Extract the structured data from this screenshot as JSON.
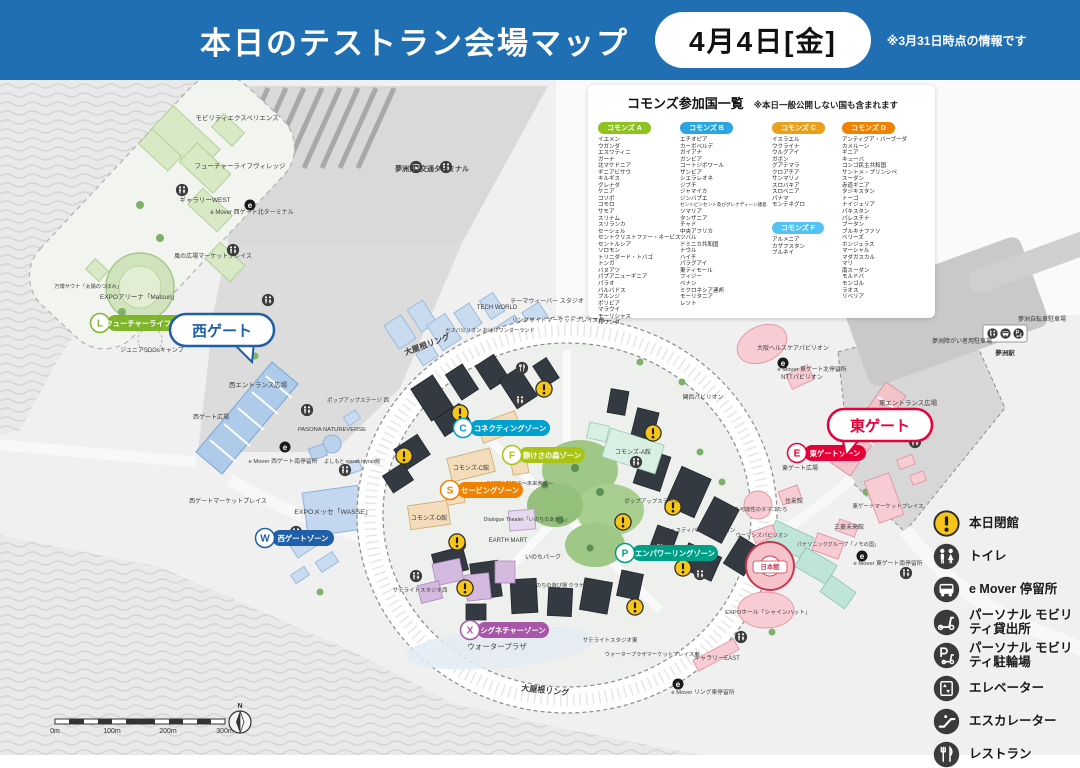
{
  "header": {
    "title": "本日のテストラン会場マップ",
    "date_badge": "4月4日[金]",
    "note": "※3月31日時点の情報です"
  },
  "commons_panel": {
    "title": "コモンズ参加国一覧",
    "note": "※本日一般公開しない国も含まれます",
    "groups": [
      {
        "label": "コモンズ A",
        "color": "#8dc21f",
        "countries": [
          "イエメン",
          "ウガンダ",
          "エスワティニ",
          "ガーナ",
          "北マケドニア",
          "ギニアビサウ",
          "キルギス",
          "グレナダ",
          "ケニア",
          "コソボ",
          "コモロ",
          "サモア",
          "スリナム",
          "スリランカ",
          "セーシェル",
          "セントクリストファー・ネービス",
          "セントルシア",
          "ソロモン",
          "トリニダード・トバゴ",
          "トンガ",
          "バヌアツ",
          "パプアニューギニア",
          "パラオ",
          "バルバドス",
          "ブルンジ",
          "ボリビア",
          "マラウイ",
          "モーリシャス",
          "ルワンダ"
        ]
      },
      {
        "label": "コモンズ B",
        "color": "#2ca6e0",
        "countries": [
          "エチオピア",
          "カーボベルデ",
          "ガイアナ",
          "ガンビア",
          "コートジボワール",
          "ザンビア",
          "シエラレオネ",
          "ジブチ",
          "ジャマイカ",
          "ジンバブエ",
          "セントビンセント及びグレナディーン諸島",
          "ソマリア",
          "タンザニア",
          "チャド",
          "中央アフリカ",
          "ツバル",
          "ドミニカ共和国",
          "ナウル",
          "ハイチ",
          "パラグアイ",
          "東ティモール",
          "フィジー",
          "ベナン",
          "ミクロネシア連邦",
          "モーリタニア",
          "レソト"
        ]
      },
      {
        "label": "コモンズ C",
        "color": "#e8a11c",
        "countries": [
          "イスラエル",
          "ウクライナ",
          "ウルグアイ",
          "ガボン",
          "グアテマラ",
          "クロアチア",
          "サンマリノ",
          "スロバキア",
          "スロベニア",
          "パナマ",
          "モンテネグロ"
        ]
      },
      {
        "label": "コモンズ F",
        "color": "#54c3f1",
        "countries": [
          "アルメニア",
          "カザフスタン",
          "ブルネイ"
        ]
      },
      {
        "label": "コモンズ D",
        "color": "#ef8200",
        "countries": [
          "アンティグア・バーブーダ",
          "カメルーン",
          "ギニア",
          "キューバ",
          "コンゴ民主共和国",
          "サントメ・プリンシペ",
          "スーダン",
          "赤道ギニア",
          "タジキスタン",
          "トーゴ",
          "ナイジェリア",
          "パキスタン",
          "パレスチナ",
          "ブータン",
          "ブルキナファソ",
          "ベリーズ",
          "ホンジュラス",
          "マーシャル",
          "マダガスカル",
          "マリ",
          "南スーダン",
          "モルドバ",
          "モンゴル",
          "ラオス",
          "リベリア"
        ]
      }
    ]
  },
  "map": {
    "zones": [
      {
        "letter": "L",
        "label": "フューチャーライフゾーン",
        "color": "#7fb52b"
      },
      {
        "letter": "W",
        "label": "西ゲートゾーン",
        "color": "#1e5fa8"
      },
      {
        "letter": "C",
        "label": "コネクティングゾーン",
        "color": "#00a0cf"
      },
      {
        "letter": "F",
        "label": "静けさの森ゾーン",
        "color": "#a9c417"
      },
      {
        "letter": "S",
        "label": "セービングゾーン",
        "color": "#ef8200"
      },
      {
        "letter": "X",
        "label": "シグネチャーゾーン",
        "color": "#a857a8"
      },
      {
        "letter": "P",
        "label": "エンパワーリングゾーン",
        "color": "#00a086"
      },
      {
        "letter": "E",
        "label": "東ゲートゾーン",
        "color": "#e50038"
      }
    ],
    "gates": [
      {
        "label": "西ゲート",
        "color": "#1e5fa8"
      },
      {
        "label": "東ゲート",
        "color": "#e50038"
      }
    ],
    "labels": [
      {
        "t": "モビリティエクスペリエンス",
        "x": 237,
        "y": 120,
        "s": 6.5
      },
      {
        "t": "フューチャーライフヴィレッジ",
        "x": 240,
        "y": 168,
        "s": 6.5
      },
      {
        "t": "ギャラリーWEST",
        "x": 205,
        "y": 202,
        "s": 6.5
      },
      {
        "t": "e Mover 西ゲート北ターミナル",
        "x": 252,
        "y": 214,
        "s": 6
      },
      {
        "t": "風の広場マーケットプレイス",
        "x": 213,
        "y": 258,
        "s": 6
      },
      {
        "t": "EXPOアリーナ「Matsuri」",
        "x": 139,
        "y": 299,
        "s": 6.5
      },
      {
        "t": "万博サウナ「太陽のつぼみ」",
        "x": 88,
        "y": 288,
        "s": 5.2
      },
      {
        "t": "ジュニアSDGsキャンプ",
        "x": 152,
        "y": 352,
        "s": 6
      },
      {
        "t": "夢洲第1交通ターミナル",
        "x": 432,
        "y": 171,
        "s": 7,
        "b": 1
      },
      {
        "t": "西エントランス広場",
        "x": 258,
        "y": 387,
        "s": 6.5
      },
      {
        "t": "西ゲート広場",
        "x": 211,
        "y": 419,
        "s": 6
      },
      {
        "t": "西ゲートマーケットプレイス",
        "x": 228,
        "y": 503,
        "s": 6
      },
      {
        "t": "PASONA NATUREVERSE",
        "x": 332,
        "y": 431,
        "s": 5.8
      },
      {
        "t": "よしもと waraii myraii館",
        "x": 352,
        "y": 463,
        "s": 5.2
      },
      {
        "t": "EXPOメッセ「WASSE」",
        "x": 333,
        "y": 514,
        "s": 6.8
      },
      {
        "t": "e Mover 西ゲート南停留所",
        "x": 283,
        "y": 463,
        "s": 5.8
      },
      {
        "t": "ポップアップステージ 西",
        "x": 358,
        "y": 402,
        "s": 5.5
      },
      {
        "t": "TECH WORLD",
        "x": 497,
        "y": 309,
        "s": 6
      },
      {
        "t": "テーマウィーバー スタジオ",
        "x": 547,
        "y": 303,
        "s": 6
      },
      {
        "t": "リングサイドマーケットプレイス西",
        "x": 558,
        "y": 322,
        "s": 5.8
      },
      {
        "t": "ガスパビリオン おばけワンダーランド",
        "x": 490,
        "y": 332,
        "s": 5.2
      },
      {
        "t": "大屋根リング",
        "x": 428,
        "y": 347,
        "s": 8,
        "r": -20,
        "b": 1
      },
      {
        "t": "大屋根リング",
        "x": 545,
        "y": 693,
        "s": 8,
        "r": 6,
        "b": 1
      },
      {
        "t": "関西パビリオン",
        "x": 703,
        "y": 399,
        "s": 5.8
      },
      {
        "t": "大阪ヘルスケアパビリオン",
        "x": 793,
        "y": 350,
        "s": 6
      },
      {
        "t": "NTTパビリオン",
        "x": 802,
        "y": 379,
        "s": 6
      },
      {
        "t": "東エントランス広場",
        "x": 908,
        "y": 405,
        "s": 6.5
      },
      {
        "t": "e Mover 東ゲート北停留所",
        "x": 812,
        "y": 371,
        "s": 5.8
      },
      {
        "t": "東ゲート広場",
        "x": 800,
        "y": 470,
        "s": 6
      },
      {
        "t": "ポップアップステージ 場内",
        "x": 658,
        "y": 503,
        "s": 5.5
      },
      {
        "t": "フェスティバルステーション",
        "x": 700,
        "y": 532,
        "s": 5.5
      },
      {
        "t": "電力館 可能性のタマゴたち",
        "x": 755,
        "y": 511,
        "s": 5.3
      },
      {
        "t": "住友館",
        "x": 794,
        "y": 503,
        "s": 6
      },
      {
        "t": "ウーマンズパビリオン",
        "x": 762,
        "y": 537,
        "s": 5.3
      },
      {
        "t": "三菱未来館",
        "x": 849,
        "y": 529,
        "s": 6
      },
      {
        "t": "パナソニックグループ「ノモの国」",
        "x": 838,
        "y": 546,
        "s": 5.2
      },
      {
        "t": "日本館",
        "x": 770,
        "y": 569,
        "s": 6.3,
        "c": "#c9384f",
        "b": 1
      },
      {
        "t": "EXPOホール「シャインハット」",
        "x": 768,
        "y": 614,
        "s": 5.8
      },
      {
        "t": "ギャラリーEAST",
        "x": 717,
        "y": 660,
        "s": 6
      },
      {
        "t": "東ゲートマーケットプレイス",
        "x": 888,
        "y": 508,
        "s": 5.5
      },
      {
        "t": "e Mover 東ゲート南停留所",
        "x": 888,
        "y": 565,
        "s": 5.8
      },
      {
        "t": "e Mover リング東停留所",
        "x": 703,
        "y": 694,
        "s": 5.8
      },
      {
        "t": "ウォータープラザ",
        "x": 497,
        "y": 649,
        "s": 7.5
      },
      {
        "t": "サテライトスタジオ西",
        "x": 420,
        "y": 592,
        "s": 5.5
      },
      {
        "t": "サテライトスタジオ東",
        "x": 610,
        "y": 642,
        "s": 5.5
      },
      {
        "t": "ウォータープラザマーケットプレイス東",
        "x": 652,
        "y": 656,
        "s": 5.3
      },
      {
        "t": "EARTH MART",
        "x": 508,
        "y": 542,
        "s": 6
      },
      {
        "t": "Dialogue Theater「いのちのあかし」",
        "x": 527,
        "y": 521,
        "s": 5.2
      },
      {
        "t": "いのちパーク",
        "x": 543,
        "y": 559,
        "s": 6
      },
      {
        "t": "いのちの遊び場 クラゲ館",
        "x": 560,
        "y": 587,
        "s": 5.2
      },
      {
        "t": "EARTH TABLE〜未来食堂〜",
        "x": 520,
        "y": 485,
        "s": 5.2
      },
      {
        "t": "コモンズ-A館",
        "x": 633,
        "y": 454,
        "s": 6
      },
      {
        "t": "コモンズ-B館",
        "x": 499,
        "y": 432,
        "s": 6
      },
      {
        "t": "コモンズ-C館",
        "x": 471,
        "y": 470,
        "s": 6
      },
      {
        "t": "コモンズ-D館",
        "x": 429,
        "y": 520,
        "s": 6
      },
      {
        "t": "夢洲障がい者用駐車場",
        "x": 962,
        "y": 343,
        "s": 6
      },
      {
        "t": "夢洲自転車駐車場",
        "x": 1042,
        "y": 321,
        "s": 6
      },
      {
        "t": "夢洲駅",
        "x": 1005,
        "y": 355,
        "s": 6.5,
        "b": 1
      }
    ],
    "alerts": [
      [
        460,
        413
      ],
      [
        544,
        389
      ],
      [
        404,
        456
      ],
      [
        653,
        433
      ],
      [
        623,
        522
      ],
      [
        673,
        507
      ],
      [
        457,
        542
      ],
      [
        465,
        588
      ],
      [
        683,
        568
      ],
      [
        635,
        607
      ]
    ],
    "facilities": [
      {
        "t": "toilet",
        "x": 182,
        "y": 190
      },
      {
        "t": "toilet",
        "x": 233,
        "y": 250
      },
      {
        "t": "toilet",
        "x": 268,
        "y": 300
      },
      {
        "t": "toilet",
        "x": 307,
        "y": 410
      },
      {
        "t": "toilet",
        "x": 345,
        "y": 470
      },
      {
        "t": "toilet",
        "x": 296,
        "y": 532
      },
      {
        "t": "toilet",
        "x": 520,
        "y": 400
      },
      {
        "t": "toilet",
        "x": 636,
        "y": 462
      },
      {
        "t": "toilet",
        "x": 700,
        "y": 574
      },
      {
        "t": "toilet",
        "x": 741,
        "y": 637
      },
      {
        "t": "toilet",
        "x": 843,
        "y": 420
      },
      {
        "t": "toilet",
        "x": 915,
        "y": 442
      },
      {
        "t": "toilet",
        "x": 906,
        "y": 573
      },
      {
        "t": "toilet",
        "x": 460,
        "y": 545
      },
      {
        "t": "toilet",
        "x": 416,
        "y": 576
      },
      {
        "t": "rest",
        "x": 522,
        "y": 368
      },
      {
        "t": "rest",
        "x": 660,
        "y": 548
      },
      {
        "t": "bus",
        "x": 416,
        "y": 167
      },
      {
        "t": "toilet",
        "x": 446,
        "y": 167
      }
    ],
    "emover_points": [
      [
        250,
        205
      ],
      [
        285,
        447
      ],
      [
        783,
        363
      ],
      [
        862,
        556
      ],
      [
        678,
        684
      ]
    ],
    "scale": {
      "ticks": [
        "0m",
        "100m",
        "200m",
        "300m"
      ]
    },
    "compass_n": "N",
    "emover_glyph": "e"
  },
  "legend": {
    "items": [
      {
        "icon": "alert",
        "label": "本日閉館"
      },
      {
        "icon": "toilet",
        "label": "トイレ"
      },
      {
        "icon": "bus",
        "label": "e Mover 停留所"
      },
      {
        "icon": "mobility",
        "label": "パーソナル モビリティ貸出所"
      },
      {
        "icon": "pmobility",
        "label": "パーソナル モビリティ駐輪場"
      },
      {
        "icon": "elevator",
        "label": "エレベーター"
      },
      {
        "icon": "escalator",
        "label": "エスカレーター"
      },
      {
        "icon": "restaurant",
        "label": "レストラン"
      }
    ]
  }
}
